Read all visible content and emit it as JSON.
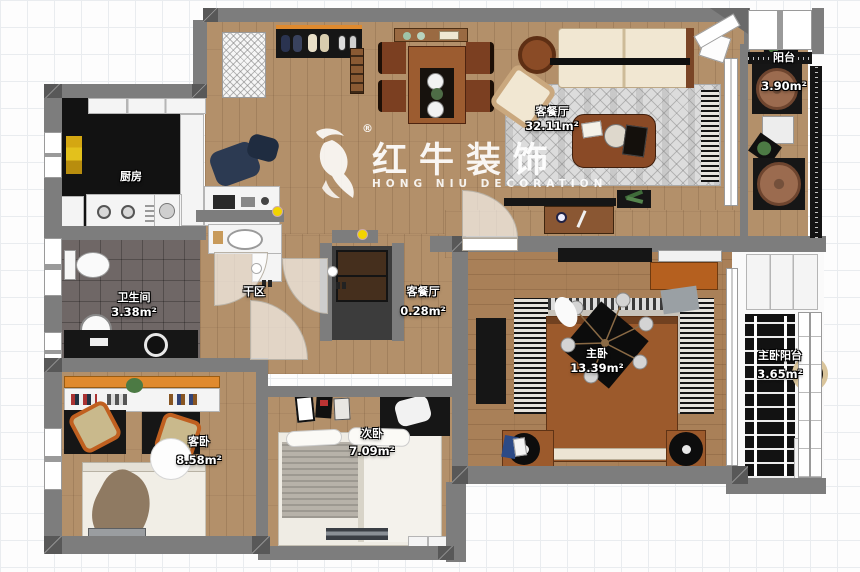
{
  "watermark": {
    "brand": "红牛装饰",
    "subtitle": "HONG NIU DECORATION",
    "registered": "®"
  },
  "rooms": [
    {
      "name": "客餐厅",
      "area": "32.11m²"
    },
    {
      "name": "阳台",
      "area": "3.90m²"
    },
    {
      "name": "厨房",
      "area": ""
    },
    {
      "name": "卫生间",
      "area": "3.38m²"
    },
    {
      "name": "干区",
      "area": ""
    },
    {
      "name": "客餐厅",
      "area": "0.28m²"
    },
    {
      "name": "主卧",
      "area": "13.39m²"
    },
    {
      "name": "主卧阳台",
      "area": "3.65m²"
    },
    {
      "name": "客卧",
      "area": "8.58m²"
    },
    {
      "name": "次卧",
      "area": "7.09m²"
    }
  ],
  "colors": {
    "wall": "#7d7d7d",
    "walldark": "#585858",
    "wood": "#b3906a",
    "woodmaster": "#a98058",
    "black": "#161616",
    "orange": "#e08a2e",
    "yellow": "#f2d400",
    "bedwood": "#9c5a2c",
    "sofa": "#f1e7d2",
    "rug": "#dcdcdc"
  }
}
